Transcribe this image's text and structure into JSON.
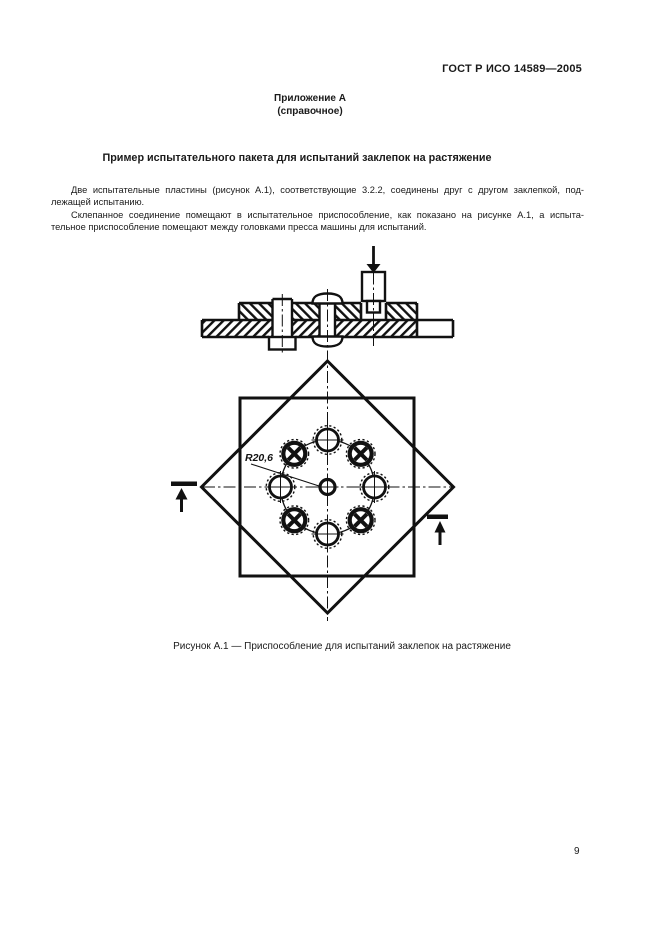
{
  "header": {
    "doc_code": "ГОСТ Р ИСО 14589—2005"
  },
  "annex": {
    "label": "Приложение А",
    "type_note": "(справочное)"
  },
  "title": "Пример испытательного пакета для испытаний заклепок на растяжение",
  "body": {
    "paragraphs": [
      {
        "lines": [
          "Две испытательные пластины (рисунок А.1), соответствующие 3.2.2, соединены друг с другом заклепкой, под-",
          "лежащей испытанию."
        ]
      },
      {
        "lines": [
          "Склепанное соединение помещают в испытательное приспособление, как показано на рисунке А.1, а испыта-",
          "тельное приспособление помещают между головками пресса машины для испытаний."
        ]
      }
    ]
  },
  "figure": {
    "radius_label": "R20,6",
    "caption": "Рисунок А.1 — Приспособление для испытаний заклепок на растяжение"
  },
  "page": {
    "number": "9"
  },
  "colors": {
    "ink": "#1a1a1a",
    "drawing_ink": "#111111",
    "paper": "#ffffff"
  }
}
